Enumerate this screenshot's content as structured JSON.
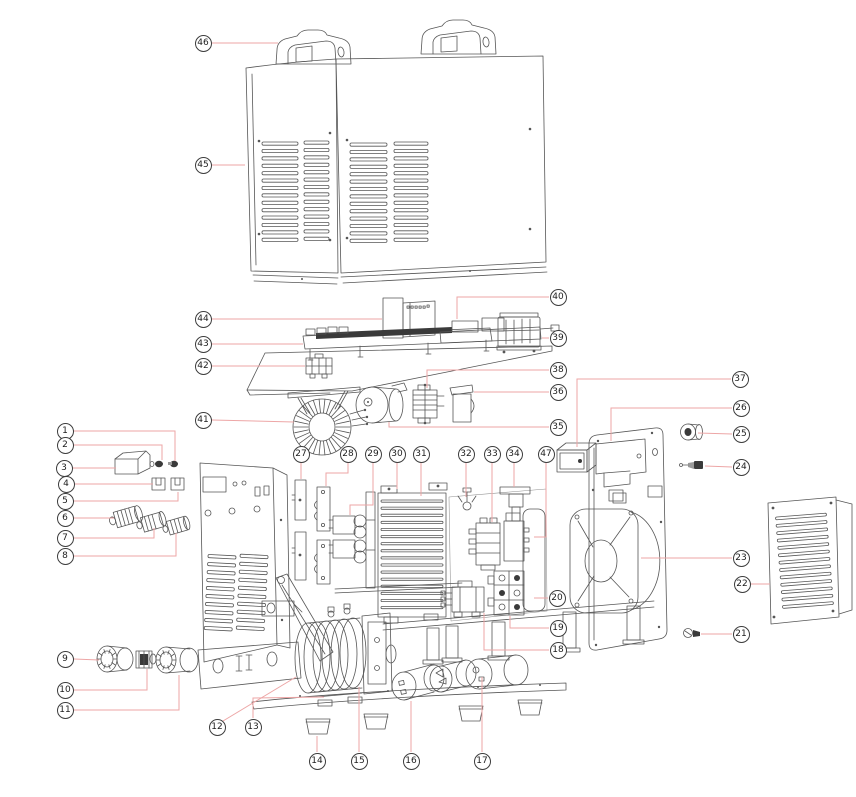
{
  "diagram": {
    "type": "exploded-parts-diagram",
    "style": {
      "background": "#ffffff",
      "line_color": "#565656",
      "leader_color": "#eda6a6",
      "balloon_border": "#3d3d3d",
      "balloon_fill": "#ffffff",
      "balloon_text": "#1d1d1d"
    },
    "callouts": [
      {
        "n": "1",
        "x": 65,
        "y": 431,
        "leader": [
          [
            74,
            431
          ],
          [
            175,
            431
          ],
          [
            175,
            461
          ]
        ]
      },
      {
        "n": "2",
        "x": 65,
        "y": 445,
        "leader": [
          [
            74,
            445
          ],
          [
            162,
            445
          ],
          [
            162,
            460
          ]
        ]
      },
      {
        "n": "3",
        "x": 64,
        "y": 468,
        "leader": [
          [
            73,
            468
          ],
          [
            116,
            468
          ]
        ]
      },
      {
        "n": "4",
        "x": 66,
        "y": 484,
        "leader": [
          [
            75,
            484
          ],
          [
            153,
            484
          ]
        ]
      },
      {
        "n": "5",
        "x": 65,
        "y": 501,
        "leader": [
          [
            74,
            501
          ],
          [
            178,
            501
          ],
          [
            178,
            492
          ]
        ]
      },
      {
        "n": "6",
        "x": 65,
        "y": 518,
        "leader": [
          [
            74,
            518
          ],
          [
            114,
            518
          ]
        ]
      },
      {
        "n": "7",
        "x": 65,
        "y": 538,
        "leader": [
          [
            74,
            538
          ],
          [
            154,
            538
          ],
          [
            154,
            528
          ]
        ]
      },
      {
        "n": "8",
        "x": 65,
        "y": 556,
        "leader": [
          [
            74,
            556
          ],
          [
            176,
            556
          ],
          [
            176,
            533
          ]
        ]
      },
      {
        "n": "9",
        "x": 65,
        "y": 659,
        "leader": [
          [
            74,
            659
          ],
          [
            99,
            660
          ]
        ]
      },
      {
        "n": "10",
        "x": 65,
        "y": 690,
        "leader": [
          [
            74,
            690
          ],
          [
            147,
            690
          ],
          [
            147,
            669
          ]
        ]
      },
      {
        "n": "11",
        "x": 65,
        "y": 710,
        "leader": [
          [
            74,
            710
          ],
          [
            179,
            710
          ],
          [
            179,
            675
          ]
        ]
      },
      {
        "n": "12",
        "x": 217,
        "y": 727,
        "leader": [
          [
            223,
            721
          ],
          [
            296,
            677
          ]
        ]
      },
      {
        "n": "13",
        "x": 253,
        "y": 727,
        "leader": [
          [
            253,
            718
          ],
          [
            253,
            698
          ],
          [
            324,
            697
          ]
        ]
      },
      {
        "n": "14",
        "x": 317,
        "y": 761,
        "leader": [
          [
            317,
            752
          ],
          [
            317,
            736
          ]
        ]
      },
      {
        "n": "15",
        "x": 359,
        "y": 761,
        "leader": [
          [
            359,
            752
          ],
          [
            359,
            687
          ]
        ]
      },
      {
        "n": "16",
        "x": 411,
        "y": 761,
        "leader": [
          [
            411,
            752
          ],
          [
            411,
            701
          ]
        ]
      },
      {
        "n": "17",
        "x": 482,
        "y": 761,
        "leader": [
          [
            482,
            752
          ],
          [
            482,
            677
          ]
        ]
      },
      {
        "n": "18",
        "x": 558,
        "y": 650,
        "leader": [
          [
            549,
            650
          ],
          [
            484,
            650
          ],
          [
            484,
            613
          ]
        ]
      },
      {
        "n": "19",
        "x": 558,
        "y": 628,
        "leader": [
          [
            549,
            628
          ],
          [
            510,
            628
          ],
          [
            510,
            616
          ]
        ]
      },
      {
        "n": "20",
        "x": 557,
        "y": 598,
        "leader": [
          [
            548,
            598
          ],
          [
            534,
            598
          ]
        ]
      },
      {
        "n": "21",
        "x": 741,
        "y": 634,
        "leader": [
          [
            732,
            634
          ],
          [
            701,
            634
          ]
        ]
      },
      {
        "n": "22",
        "x": 742,
        "y": 584,
        "leader": [
          [
            751,
            584
          ],
          [
            770,
            584
          ]
        ]
      },
      {
        "n": "23",
        "x": 741,
        "y": 558,
        "leader": [
          [
            732,
            558
          ],
          [
            641,
            558
          ]
        ]
      },
      {
        "n": "24",
        "x": 741,
        "y": 467,
        "leader": [
          [
            732,
            467
          ],
          [
            705,
            466
          ]
        ]
      },
      {
        "n": "25",
        "x": 741,
        "y": 434,
        "leader": [
          [
            732,
            434
          ],
          [
            698,
            433
          ]
        ]
      },
      {
        "n": "26",
        "x": 741,
        "y": 408,
        "leader": [
          [
            732,
            408
          ],
          [
            611,
            408
          ],
          [
            611,
            441
          ]
        ]
      },
      {
        "n": "27",
        "x": 301,
        "y": 454,
        "leader": [
          [
            301,
            463
          ],
          [
            301,
            479
          ]
        ]
      },
      {
        "n": "28",
        "x": 348,
        "y": 454,
        "leader": [
          [
            348,
            463
          ],
          [
            348,
            473
          ],
          [
            326,
            473
          ],
          [
            326,
            486
          ]
        ]
      },
      {
        "n": "29",
        "x": 373,
        "y": 454,
        "leader": [
          [
            373,
            463
          ],
          [
            373,
            505
          ],
          [
            350,
            505
          ],
          [
            350,
            515
          ]
        ]
      },
      {
        "n": "30",
        "x": 397,
        "y": 454,
        "leader": [
          [
            397,
            463
          ],
          [
            397,
            489
          ]
        ]
      },
      {
        "n": "31",
        "x": 421,
        "y": 454,
        "leader": [
          [
            421,
            463
          ],
          [
            421,
            496
          ]
        ]
      },
      {
        "n": "32",
        "x": 466,
        "y": 454,
        "leader": [
          [
            466,
            463
          ],
          [
            466,
            497
          ]
        ]
      },
      {
        "n": "33",
        "x": 492,
        "y": 454,
        "leader": [
          [
            492,
            463
          ],
          [
            492,
            522
          ]
        ]
      },
      {
        "n": "34",
        "x": 514,
        "y": 454,
        "leader": [
          [
            514,
            463
          ],
          [
            514,
            487
          ]
        ]
      },
      {
        "n": "35",
        "x": 558,
        "y": 427,
        "leader": [
          [
            549,
            427
          ],
          [
            389,
            427
          ],
          [
            389,
            422
          ]
        ]
      },
      {
        "n": "36",
        "x": 558,
        "y": 392,
        "leader": [
          [
            549,
            392
          ],
          [
            474,
            392
          ]
        ]
      },
      {
        "n": "37",
        "x": 740,
        "y": 379,
        "leader": [
          [
            731,
            379
          ],
          [
            577,
            379
          ],
          [
            577,
            447
          ]
        ]
      },
      {
        "n": "38",
        "x": 558,
        "y": 370,
        "leader": [
          [
            549,
            370
          ],
          [
            427,
            370
          ],
          [
            427,
            388
          ]
        ]
      },
      {
        "n": "39",
        "x": 558,
        "y": 338,
        "leader": [
          [
            549,
            338
          ],
          [
            542,
            338
          ]
        ]
      },
      {
        "n": "40",
        "x": 558,
        "y": 297,
        "leader": [
          [
            549,
            297
          ],
          [
            457,
            297
          ],
          [
            457,
            319
          ]
        ]
      },
      {
        "n": "41",
        "x": 203,
        "y": 420,
        "leader": [
          [
            212,
            420
          ],
          [
            294,
            422
          ]
        ]
      },
      {
        "n": "42",
        "x": 203,
        "y": 366,
        "leader": [
          [
            212,
            366
          ],
          [
            305,
            366
          ]
        ]
      },
      {
        "n": "43",
        "x": 203,
        "y": 344,
        "leader": [
          [
            212,
            344
          ],
          [
            303,
            344
          ]
        ]
      },
      {
        "n": "44",
        "x": 203,
        "y": 319,
        "leader": [
          [
            212,
            319
          ],
          [
            382,
            319
          ]
        ]
      },
      {
        "n": "45",
        "x": 203,
        "y": 165,
        "leader": [
          [
            212,
            165
          ],
          [
            245,
            165
          ]
        ]
      },
      {
        "n": "46",
        "x": 203,
        "y": 43,
        "leader": [
          [
            212,
            43
          ],
          [
            278,
            43
          ]
        ]
      },
      {
        "n": "47",
        "x": 546,
        "y": 454,
        "leader": [
          [
            546,
            463
          ],
          [
            546,
            537
          ],
          [
            534,
            537
          ]
        ]
      }
    ]
  }
}
